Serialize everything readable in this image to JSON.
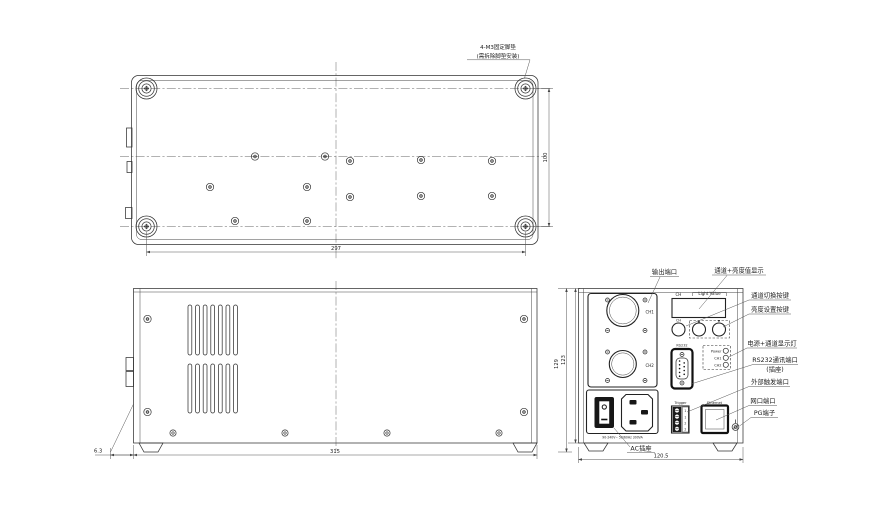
{
  "drawing": {
    "annotation": {
      "line1": "4-M3固定脚垫",
      "line2": "(需拆除脚垫安装)"
    },
    "dimensions": {
      "bottom_width": "297",
      "bottom_depth": "100",
      "side_length": "315",
      "foot_offset": "6.3",
      "height_total": "129",
      "height_body": "123",
      "panel_width": "120.5"
    },
    "panel": {
      "display_label_ch": "CH",
      "display_label_value": "Light Value",
      "btn_ch": "CH",
      "btn_up": "▲",
      "btn_down": "▼",
      "ch1": "CH1",
      "ch2": "CH2",
      "rs232": "RS232",
      "led_power": "Power",
      "led_ch1": "CH1",
      "led_ch2": "CH2",
      "trigger": "Trigger",
      "trigger_pins": [
        "1",
        "1",
        "2",
        "2"
      ],
      "ethernet": "Ethernet",
      "power_rating": "90-240V~ 50/60Hz 300VA"
    },
    "callouts": {
      "output_port": "输出端口",
      "display": "通道+亮度值显示",
      "ch_switch": "通道切换按键",
      "brightness": "亮度设置按键",
      "leds": "电源+通道显示灯",
      "rs232_line1": "RS232通讯端口",
      "rs232_line2": "(插座)",
      "trigger": "外部触发端口",
      "lan": "网口端口",
      "pg": "PG端子",
      "ac": "AC插座"
    }
  }
}
